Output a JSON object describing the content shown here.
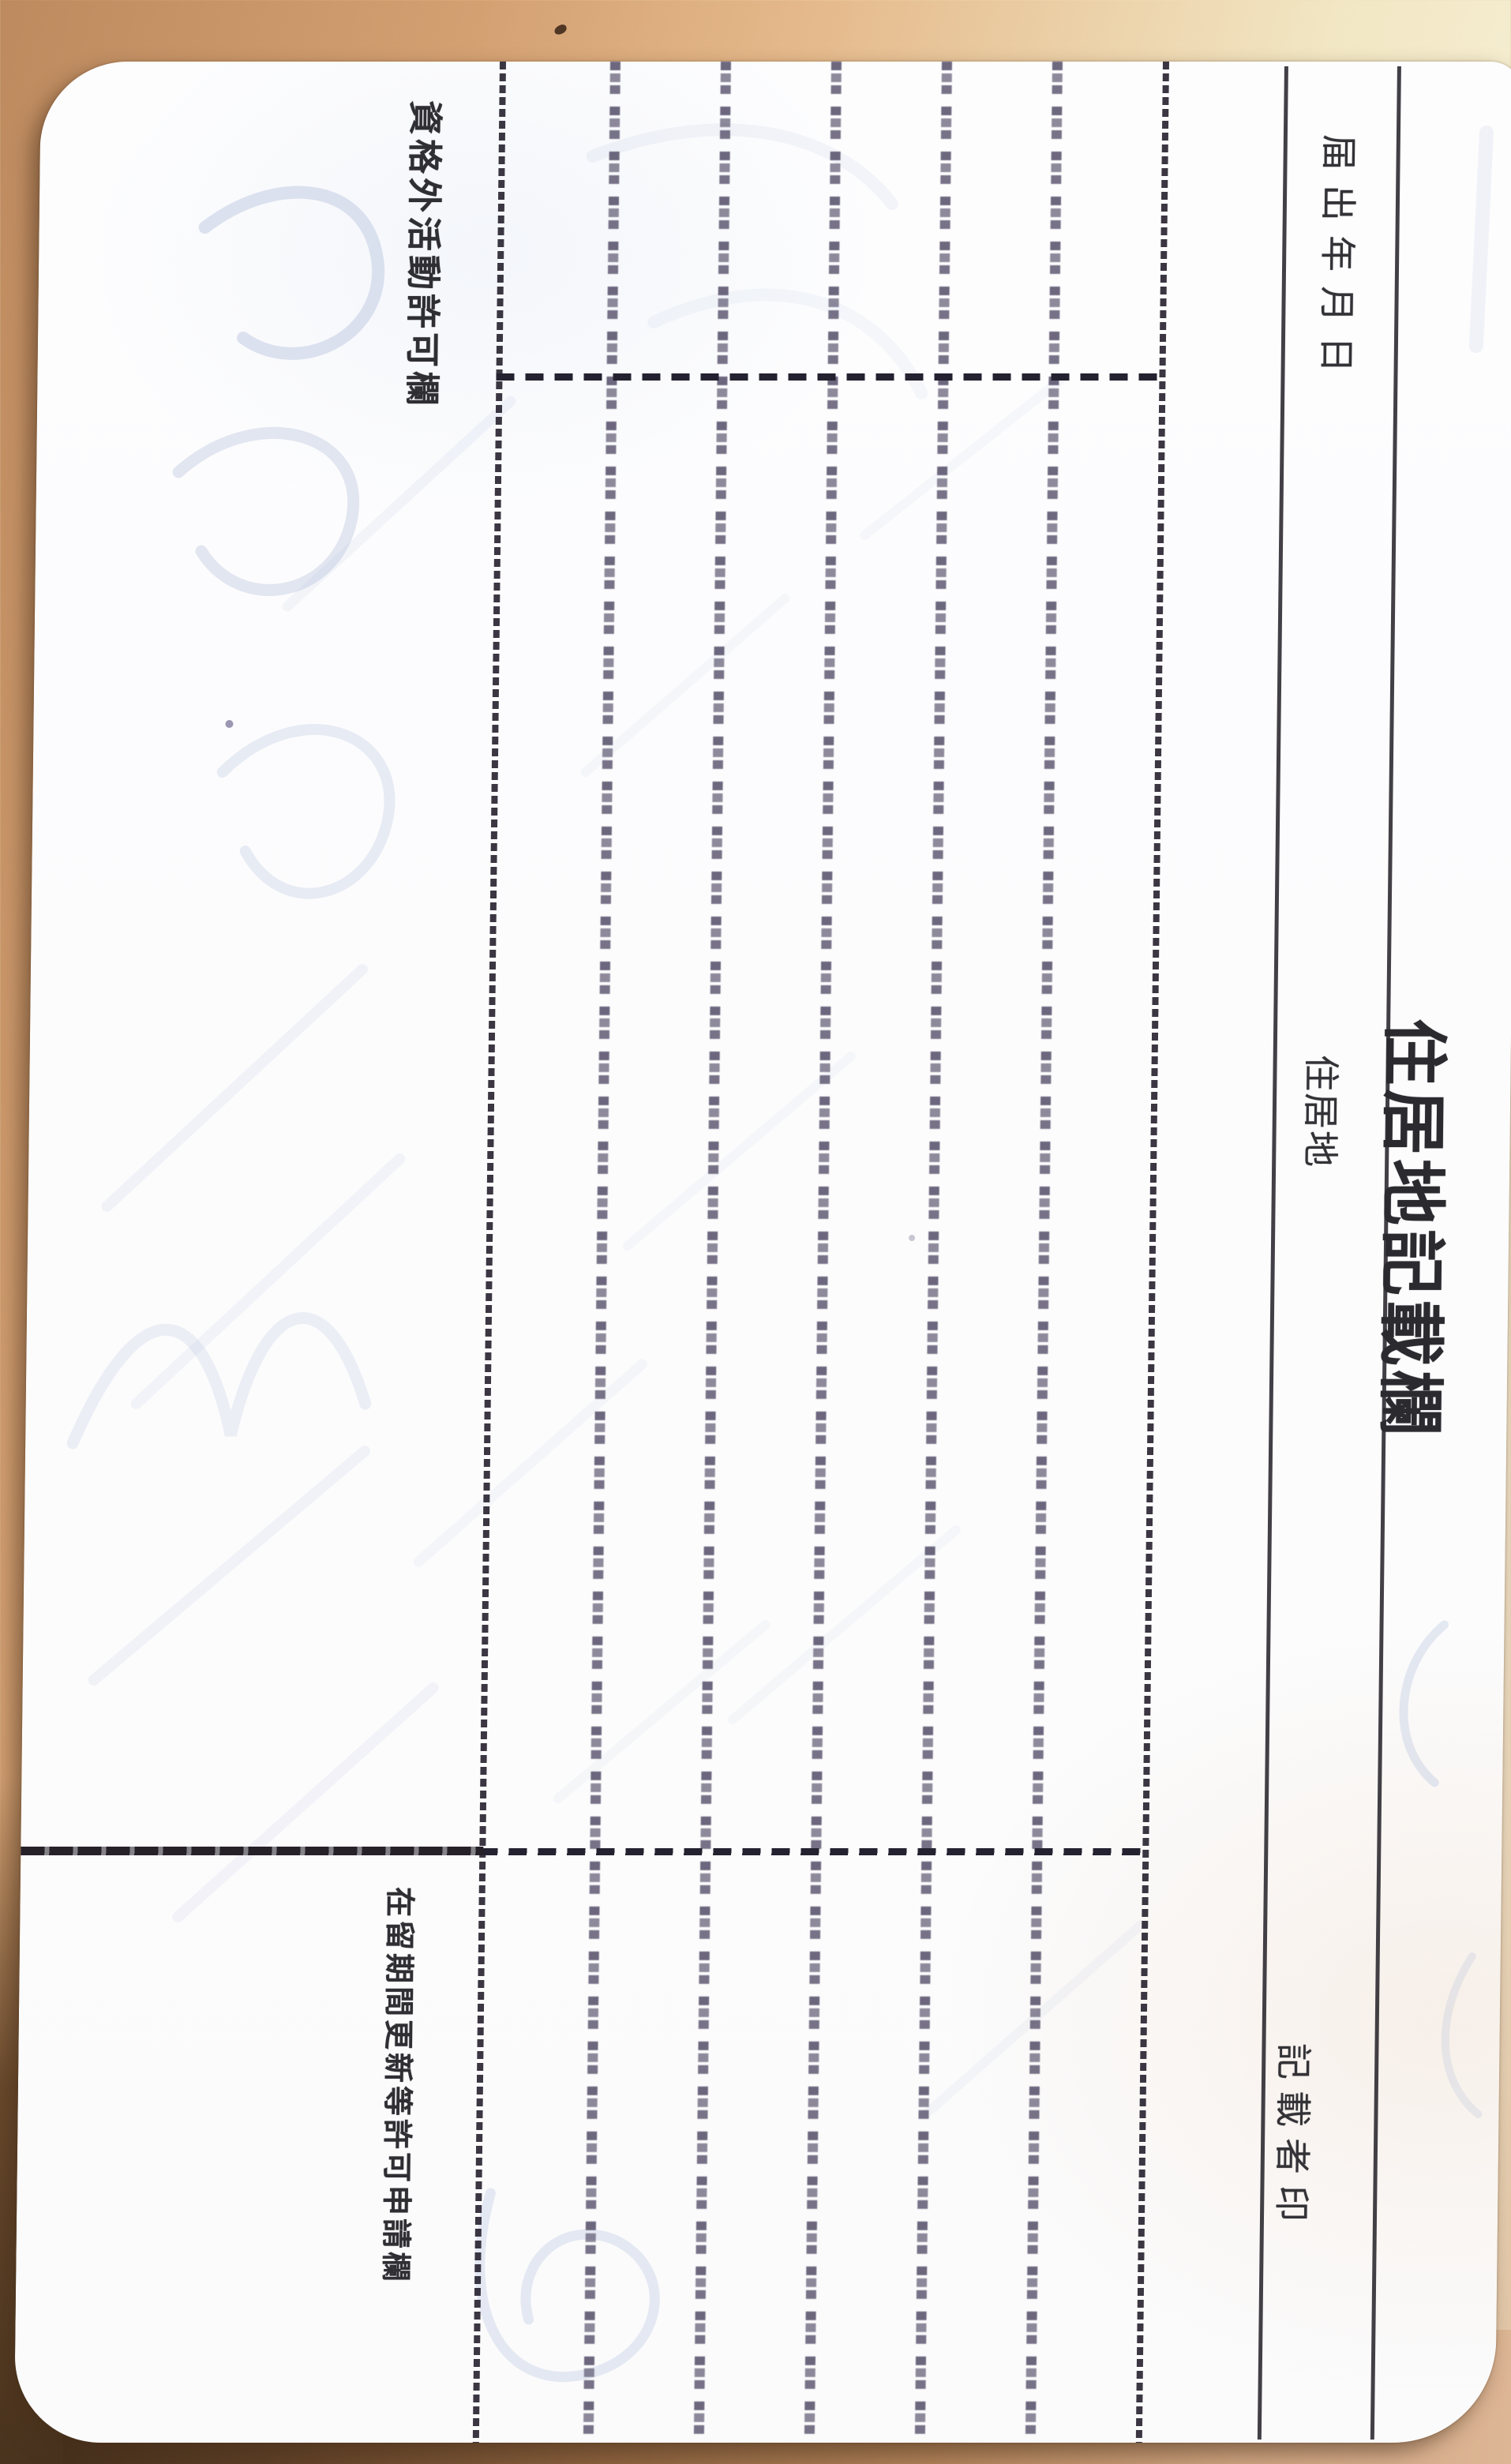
{
  "page": {
    "title": "住居地記載欄",
    "column_headers": {
      "notification_date": "届出年月日",
      "residence": "住居地",
      "recorder_seal": "記載者印"
    },
    "section_headers": {
      "activity_permission": "資格外活動許可欄",
      "stay_extension_application": "在留期間更新等許可申請欄"
    }
  },
  "colors": {
    "paper": "#fcfcfd",
    "ink_text": "#333236",
    "table_rule": "#2c2a2e",
    "dashed_rule": "#2a2532",
    "micro_guide_dots": "#443e5a",
    "ghost_ink_blue": "#aab8d8",
    "desk_tan": "#d3a072",
    "desk_cream": "#f7f1d8",
    "desk_dark_brown": "#49331e"
  }
}
